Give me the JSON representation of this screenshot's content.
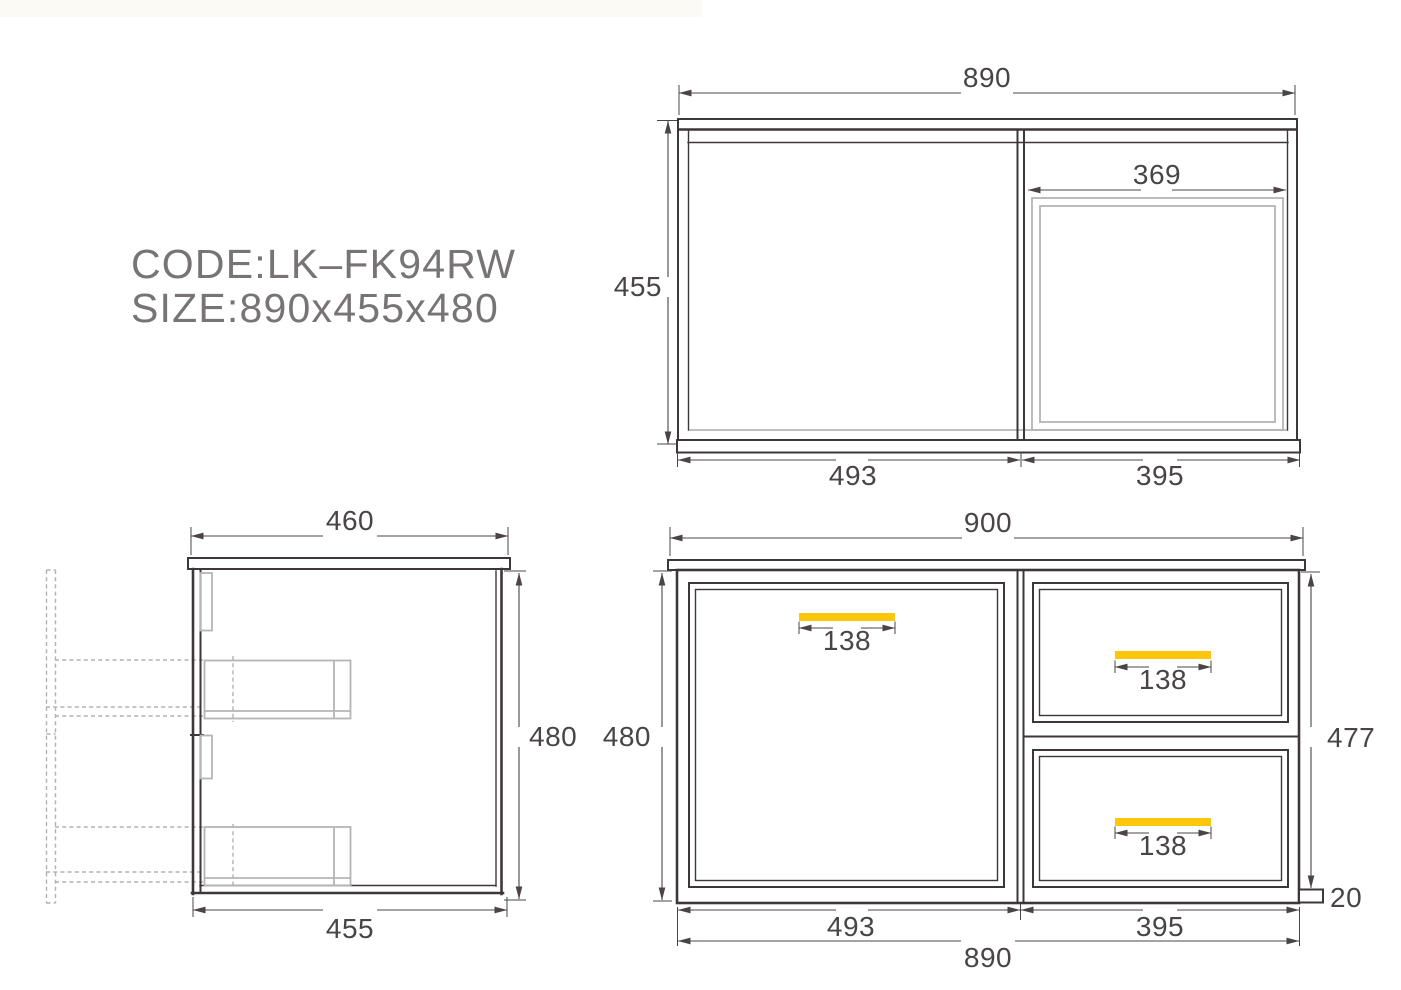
{
  "info": {
    "code_line": "CODE:LK–FK94RW",
    "size_line": "SIZE:890x455x480"
  },
  "colors": {
    "accent": "#fcc60d",
    "line": "#3e3738",
    "dim_text": "#4a4445",
    "muted_gray": "#b5b5b5",
    "label_gray": "#787374",
    "header_strip": "#fbfaf4"
  },
  "top_view": {
    "width": "890",
    "depth": "455",
    "sink_width": "369",
    "bottom_left": "493",
    "bottom_right": "395"
  },
  "side_view": {
    "top_width": "460",
    "height": "480",
    "bottom_width": "455"
  },
  "front_view": {
    "width": "900",
    "height_left": "480",
    "height_right": "477",
    "door_handle": "138",
    "top_drawer_handle": "138",
    "bottom_drawer_handle": "138",
    "bottom_left": "493",
    "bottom_right": "395",
    "bottom_total": "890",
    "plinth": "20"
  }
}
